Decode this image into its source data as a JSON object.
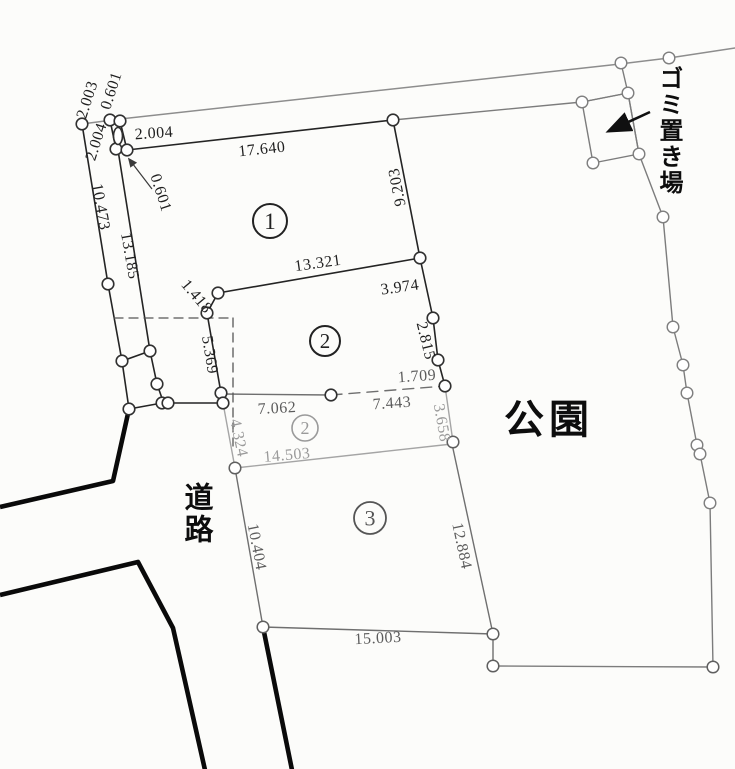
{
  "region_labels": {
    "park": "公園",
    "road": "道路",
    "garbage": "ゴミ置き場"
  },
  "parcels": [
    {
      "num": "1",
      "x": 270,
      "y": 221,
      "r": 17,
      "tone": "dark",
      "font": 23
    },
    {
      "num": "2",
      "x": 325,
      "y": 341,
      "r": 15,
      "tone": "dark",
      "font": 21
    },
    {
      "num": "2",
      "x": 305,
      "y": 428,
      "r": 13,
      "tone": "faded",
      "font": 18
    },
    {
      "num": "3",
      "x": 370,
      "y": 518,
      "r": 16,
      "tone": "mid",
      "font": 22
    }
  ],
  "measurements": [
    {
      "value": "2.003",
      "x": 88,
      "y": 100,
      "rot": -72,
      "tone": "dark"
    },
    {
      "value": "0.601",
      "x": 112,
      "y": 91,
      "rot": -72,
      "tone": "dark"
    },
    {
      "value": "2.004",
      "x": 97,
      "y": 142,
      "rot": -72,
      "tone": "dark"
    },
    {
      "value": "2.004",
      "x": 154,
      "y": 134,
      "rot": -4,
      "tone": "dark"
    },
    {
      "value": "17.640",
      "x": 262,
      "y": 150,
      "rot": -6,
      "tone": "dark"
    },
    {
      "value": "0.601",
      "x": 160,
      "y": 193,
      "rot": 72,
      "tone": "dark"
    },
    {
      "value": "10.473",
      "x": 100,
      "y": 207,
      "rot": 80,
      "tone": "dark"
    },
    {
      "value": "13.185",
      "x": 129,
      "y": 256,
      "rot": 80,
      "tone": "dark"
    },
    {
      "value": "9.203",
      "x": 398,
      "y": 187,
      "rot": -101,
      "tone": "dark"
    },
    {
      "value": "13.321",
      "x": 318,
      "y": 264,
      "rot": -8,
      "tone": "dark"
    },
    {
      "value": "3.974",
      "x": 400,
      "y": 288,
      "rot": -8,
      "tone": "dark"
    },
    {
      "value": "1.418",
      "x": 196,
      "y": 297,
      "rot": 50,
      "tone": "dark"
    },
    {
      "value": "2.815",
      "x": 425,
      "y": 341,
      "rot": 76,
      "tone": "dark"
    },
    {
      "value": "5.369",
      "x": 209,
      "y": 355,
      "rot": 81,
      "tone": "dark"
    },
    {
      "value": "1.709",
      "x": 417,
      "y": 377,
      "rot": -4,
      "tone": "mid"
    },
    {
      "value": "7.062",
      "x": 277,
      "y": 409,
      "rot": -3,
      "tone": "mid"
    },
    {
      "value": "7.443",
      "x": 392,
      "y": 404,
      "rot": -4,
      "tone": "mid"
    },
    {
      "value": "3.658",
      "x": 441,
      "y": 423,
      "rot": 80,
      "tone": "faded"
    },
    {
      "value": "4.324",
      "x": 238,
      "y": 438,
      "rot": 78,
      "tone": "faded"
    },
    {
      "value": "14.503",
      "x": 287,
      "y": 456,
      "rot": -5,
      "tone": "faded"
    },
    {
      "value": "10.404",
      "x": 256,
      "y": 547,
      "rot": 79,
      "tone": "mid"
    },
    {
      "value": "12.884",
      "x": 461,
      "y": 546,
      "rot": 78,
      "tone": "mid"
    },
    {
      "value": "15.003",
      "x": 378,
      "y": 639,
      "rot": -3,
      "tone": "mid"
    }
  ],
  "geometry": {
    "lines": [
      {
        "name": "street-line",
        "cls": "street",
        "pts": [
          [
            82,
            124
          ],
          [
            120,
            119
          ],
          [
            620,
            64
          ],
          [
            669,
            58
          ],
          [
            735,
            48
          ]
        ]
      },
      {
        "name": "park-north-boundary",
        "cls": "park",
        "pts": [
          [
            393,
            120
          ],
          [
            582,
            102
          ],
          [
            628,
            93
          ]
        ]
      },
      {
        "name": "park-street-link",
        "cls": "park",
        "pts": [
          [
            621,
            63
          ],
          [
            628,
            93
          ]
        ]
      },
      {
        "name": "park-east-boundary",
        "cls": "park",
        "pts": [
          [
            628,
            93
          ],
          [
            639,
            154
          ],
          [
            663,
            217
          ],
          [
            673,
            327
          ],
          [
            683,
            365
          ],
          [
            687,
            393
          ],
          [
            697,
            445
          ],
          [
            700,
            454
          ],
          [
            710,
            503
          ],
          [
            713,
            667
          ]
        ]
      },
      {
        "name": "garbage-area-outline",
        "cls": "park",
        "pts": [
          [
            582,
            102
          ],
          [
            628,
            93
          ],
          [
            639,
            154
          ],
          [
            593,
            163
          ],
          [
            582,
            102
          ]
        ]
      },
      {
        "name": "park-south-boundary",
        "cls": "park",
        "pts": [
          [
            493,
            666
          ],
          [
            713,
            667
          ]
        ]
      },
      {
        "name": "west-outer-boundary",
        "cls": "dark",
        "pts": [
          [
            82,
            124
          ],
          [
            108,
            284
          ],
          [
            122,
            361
          ],
          [
            129,
            409
          ]
        ]
      },
      {
        "name": "west-inner-boundary",
        "cls": "dark",
        "pts": [
          [
            118,
            150
          ],
          [
            150,
            351
          ],
          [
            157,
            384
          ],
          [
            164,
            404
          ]
        ]
      },
      {
        "name": "corner-strip-left",
        "cls": "dark",
        "pts": [
          [
            110,
            120
          ],
          [
            116,
            149
          ]
        ]
      },
      {
        "name": "corner-strip-right",
        "cls": "dark",
        "pts": [
          [
            120,
            121
          ],
          [
            127,
            150
          ]
        ]
      },
      {
        "name": "corner-strip-bottom",
        "cls": "dark",
        "pts": [
          [
            116,
            149
          ],
          [
            127,
            150
          ]
        ]
      },
      {
        "name": "parcel1-north-edge",
        "cls": "dark",
        "pts": [
          [
            127,
            150
          ],
          [
            393,
            120
          ]
        ]
      },
      {
        "name": "east-boundary-chain",
        "cls": "dark",
        "pts": [
          [
            393,
            120
          ],
          [
            420,
            258
          ],
          [
            433,
            318
          ],
          [
            438,
            360
          ],
          [
            445,
            386
          ]
        ]
      },
      {
        "name": "parcel1-south-edge",
        "cls": "dark",
        "pts": [
          [
            218,
            293
          ],
          [
            420,
            258
          ]
        ]
      },
      {
        "name": "jog-segment",
        "cls": "dark",
        "pts": [
          [
            218,
            293
          ],
          [
            207,
            313
          ]
        ]
      },
      {
        "name": "parcel2-west-edge",
        "cls": "dark",
        "pts": [
          [
            207,
            313
          ],
          [
            221,
            393
          ]
        ]
      },
      {
        "name": "cross-tie-segment",
        "cls": "dark",
        "pts": [
          [
            122,
            361
          ],
          [
            150,
            351
          ]
        ]
      },
      {
        "name": "road-frontage-line",
        "cls": "dark",
        "pts": [
          [
            129,
            409
          ],
          [
            162,
            403
          ],
          [
            168,
            403
          ],
          [
            223,
            403
          ]
        ]
      },
      {
        "name": "frontage-connector",
        "cls": "dark",
        "pts": [
          [
            221,
            393
          ],
          [
            223,
            403
          ]
        ]
      },
      {
        "name": "parcel2-south-edge",
        "cls": "mid",
        "pts": [
          [
            222,
            394
          ],
          [
            331,
            395
          ]
        ]
      },
      {
        "name": "parcel2-south-edge-dashed",
        "cls": "dashmid",
        "pts": [
          [
            331,
            395
          ],
          [
            445,
            386
          ]
        ]
      },
      {
        "name": "strip-west-edge",
        "cls": "faded",
        "pts": [
          [
            223,
            403
          ],
          [
            235,
            468
          ]
        ]
      },
      {
        "name": "strip-south-edge",
        "cls": "faded",
        "pts": [
          [
            235,
            468
          ],
          [
            452,
            444
          ]
        ]
      },
      {
        "name": "strip-east-edge",
        "cls": "faded",
        "pts": [
          [
            445,
            386
          ],
          [
            453,
            442
          ]
        ]
      },
      {
        "name": "parcel3-west-edge",
        "cls": "mid",
        "pts": [
          [
            235,
            468
          ],
          [
            263,
            627
          ]
        ]
      },
      {
        "name": "parcel3-south-edge",
        "cls": "mid",
        "pts": [
          [
            263,
            627
          ],
          [
            493,
            634
          ]
        ]
      },
      {
        "name": "parcel3-east-edge",
        "cls": "mid",
        "pts": [
          [
            452,
            444
          ],
          [
            493,
            634
          ]
        ]
      },
      {
        "name": "parcel3-se-connector",
        "cls": "mid",
        "pts": [
          [
            493,
            634
          ],
          [
            493,
            666
          ]
        ]
      },
      {
        "name": "setback-dashed-horizontal",
        "cls": "dash",
        "pts": [
          [
            114,
            318
          ],
          [
            233,
            318
          ]
        ]
      },
      {
        "name": "setback-dashed-vertical",
        "cls": "dash",
        "pts": [
          [
            233,
            318
          ],
          [
            233,
            446
          ]
        ]
      },
      {
        "name": "road-edge-upper",
        "cls": "thick",
        "pts": [
          [
            129,
            409
          ],
          [
            113,
            481
          ],
          [
            0,
            507
          ]
        ]
      },
      {
        "name": "road-edge-lower",
        "cls": "thick",
        "pts": [
          [
            0,
            595
          ],
          [
            138,
            562
          ],
          [
            173,
            628
          ],
          [
            205,
            770
          ]
        ]
      },
      {
        "name": "road-edge-east",
        "cls": "thick",
        "pts": [
          [
            263,
            627
          ],
          [
            292,
            770
          ]
        ]
      }
    ],
    "points": [
      {
        "x": 82,
        "y": 124,
        "cls": "dark"
      },
      {
        "x": 110,
        "y": 120,
        "cls": "dark"
      },
      {
        "x": 120,
        "y": 121,
        "cls": "dark"
      },
      {
        "x": 116,
        "y": 149,
        "cls": "dark"
      },
      {
        "x": 127,
        "y": 150,
        "cls": "dark"
      },
      {
        "x": 108,
        "y": 284,
        "cls": "dark"
      },
      {
        "x": 122,
        "y": 361,
        "cls": "dark"
      },
      {
        "x": 129,
        "y": 409,
        "cls": "dark"
      },
      {
        "x": 150,
        "y": 351,
        "cls": "dark"
      },
      {
        "x": 157,
        "y": 384,
        "cls": "dark"
      },
      {
        "x": 162,
        "y": 403,
        "cls": "dark"
      },
      {
        "x": 168,
        "y": 403,
        "cls": "dark"
      },
      {
        "x": 221,
        "y": 393,
        "cls": "dark"
      },
      {
        "x": 223,
        "y": 403,
        "cls": "dark"
      },
      {
        "x": 218,
        "y": 293,
        "cls": "dark"
      },
      {
        "x": 207,
        "y": 313,
        "cls": "dark"
      },
      {
        "x": 393,
        "y": 120,
        "cls": "dark"
      },
      {
        "x": 420,
        "y": 258,
        "cls": "dark"
      },
      {
        "x": 433,
        "y": 318,
        "cls": "dark"
      },
      {
        "x": 438,
        "y": 360,
        "cls": "dark"
      },
      {
        "x": 445,
        "y": 386,
        "cls": "dark"
      },
      {
        "x": 331,
        "y": 395,
        "cls": "dark"
      },
      {
        "x": 453,
        "y": 442,
        "cls": "mid"
      },
      {
        "x": 235,
        "y": 468,
        "cls": "mid"
      },
      {
        "x": 263,
        "y": 627,
        "cls": "mid"
      },
      {
        "x": 493,
        "y": 634,
        "cls": "mid"
      },
      {
        "x": 493,
        "y": 666,
        "cls": "mid"
      },
      {
        "x": 713,
        "y": 667,
        "cls": "mid"
      },
      {
        "x": 621,
        "y": 63,
        "cls": "gray"
      },
      {
        "x": 669,
        "y": 58,
        "cls": "gray"
      },
      {
        "x": 628,
        "y": 93,
        "cls": "gray"
      },
      {
        "x": 582,
        "y": 102,
        "cls": "gray"
      },
      {
        "x": 639,
        "y": 154,
        "cls": "gray"
      },
      {
        "x": 593,
        "y": 163,
        "cls": "gray"
      },
      {
        "x": 663,
        "y": 217,
        "cls": "gray"
      },
      {
        "x": 673,
        "y": 327,
        "cls": "gray"
      },
      {
        "x": 683,
        "y": 365,
        "cls": "gray"
      },
      {
        "x": 687,
        "y": 393,
        "cls": "gray"
      },
      {
        "x": 697,
        "y": 445,
        "cls": "gray"
      },
      {
        "x": 700,
        "y": 454,
        "cls": "gray"
      },
      {
        "x": 710,
        "y": 503,
        "cls": "gray"
      }
    ],
    "monument_oval": {
      "cx": 118,
      "cy": 136,
      "rx": 4.5,
      "ry": 8.5
    },
    "arrows": [
      {
        "name": "garbage-pointer-arrow",
        "x1": 650,
        "y1": 112,
        "x2": 609,
        "y2": 131,
        "w": 2.6,
        "marker": "big"
      },
      {
        "name": "dimension-pointer-arrow",
        "x1": 152,
        "y1": 189,
        "x2": 129,
        "y2": 159,
        "w": 1.2,
        "marker": "small"
      }
    ]
  }
}
